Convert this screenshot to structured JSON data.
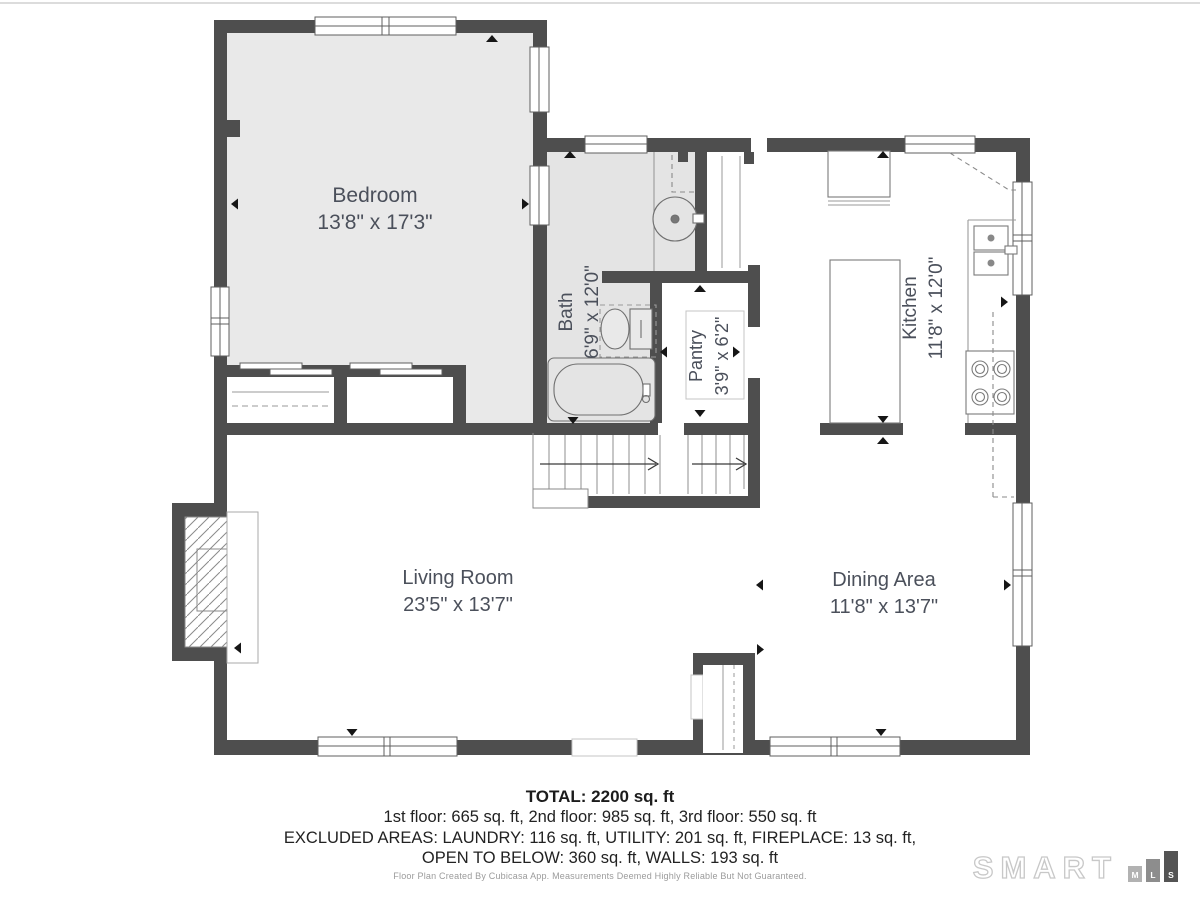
{
  "colors": {
    "wall": "#4e4e4e",
    "room_fill": "#e9e9e9",
    "bath_fill": "#e4e4e4",
    "label_text": "#4b505b",
    "logo_outline": "#c8c8c8",
    "logo_bar_m": "#b2b2b2",
    "logo_bar_l": "#8d8d8d",
    "logo_bar_s": "#545454"
  },
  "rooms": [
    {
      "id": "bedroom",
      "name": "Bedroom",
      "dims": "13'8\" x 17'3\""
    },
    {
      "id": "bath",
      "name": "Bath",
      "dims": "6'9\" x 12'0\""
    },
    {
      "id": "pantry",
      "name": "Pantry",
      "dims": "3'9\" x 6'2\""
    },
    {
      "id": "kitchen",
      "name": "Kitchen",
      "dims": "11'8\" x 12'0\""
    },
    {
      "id": "living",
      "name": "Living Room",
      "dims": "23'5\" x 13'7\""
    },
    {
      "id": "dining",
      "name": "Dining Area",
      "dims": "11'8\" x 13'7\""
    }
  ],
  "summary": {
    "total": "TOTAL: 2200 sq. ft",
    "floors": "1st floor: 665 sq. ft, 2nd floor: 985 sq. ft, 3rd floor: 550 sq. ft",
    "excluded_line1": "EXCLUDED AREAS: LAUNDRY: 116 sq. ft, UTILITY: 201 sq. ft, FIREPLACE: 13 sq. ft,",
    "excluded_line2": "OPEN TO BELOW: 360 sq. ft, WALLS: 193 sq. ft"
  },
  "disclaimer": "Floor Plan Created By Cubicasa App. Measurements Deemed Highly Reliable But Not Guaranteed.",
  "logo": {
    "brand": "SMART",
    "bars": [
      "M",
      "L",
      "S"
    ]
  }
}
